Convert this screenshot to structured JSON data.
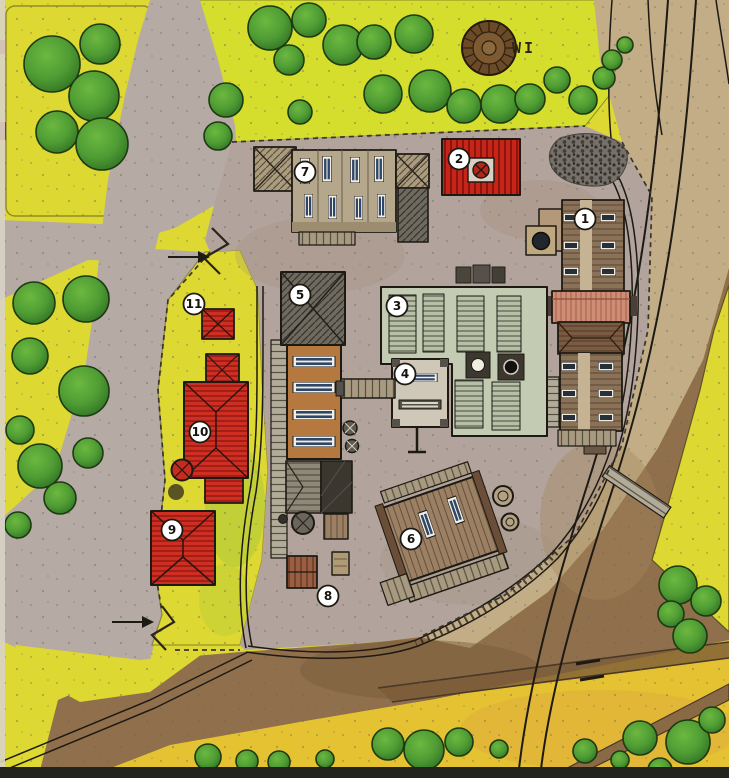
{
  "map": {
    "title": "Hand-drawn watercolor site plan of an industrial yard with numbered buildings",
    "landmark_label": "WI",
    "marker_style": "numbered-white-circle",
    "markers": [
      {
        "number": "1",
        "x": 585,
        "y": 219
      },
      {
        "number": "2",
        "x": 459,
        "y": 159
      },
      {
        "number": "3",
        "x": 397,
        "y": 306
      },
      {
        "number": "4",
        "x": 405,
        "y": 374
      },
      {
        "number": "5",
        "x": 300,
        "y": 295
      },
      {
        "number": "6",
        "x": 411,
        "y": 539
      },
      {
        "number": "7",
        "x": 305,
        "y": 172
      },
      {
        "number": "8",
        "x": 328,
        "y": 596
      },
      {
        "number": "9",
        "x": 172,
        "y": 530
      },
      {
        "number": "10",
        "x": 200,
        "y": 432
      },
      {
        "number": "11",
        "x": 194,
        "y": 304
      }
    ],
    "entrances": [
      {
        "id": "north-gate",
        "x": 168,
        "y": 257,
        "direction": "right"
      },
      {
        "id": "south-gate",
        "x": 112,
        "y": 622,
        "direction": "right"
      }
    ],
    "colors": {
      "field": "#ddd832",
      "field_top": "#d5dd2d",
      "field_orange": "#e5c231",
      "road": "#b6aaa4",
      "yard": "#b2a49c",
      "embankment": "#c2ad87",
      "earth": "#8f6f4c",
      "tree": "#4f9c34",
      "tree_dark": "#2e6e22",
      "building_red": "#ce2f22",
      "building_orange": "#b5793f",
      "building_sage": "#c3cbb3",
      "building_brown": "#8a7258",
      "building_pink": "#cf8d76",
      "roof_dark": "#6e6a60",
      "track": "#1d1a14",
      "badge_bg": "#ffffff",
      "badge_text": "#15120e"
    }
  }
}
